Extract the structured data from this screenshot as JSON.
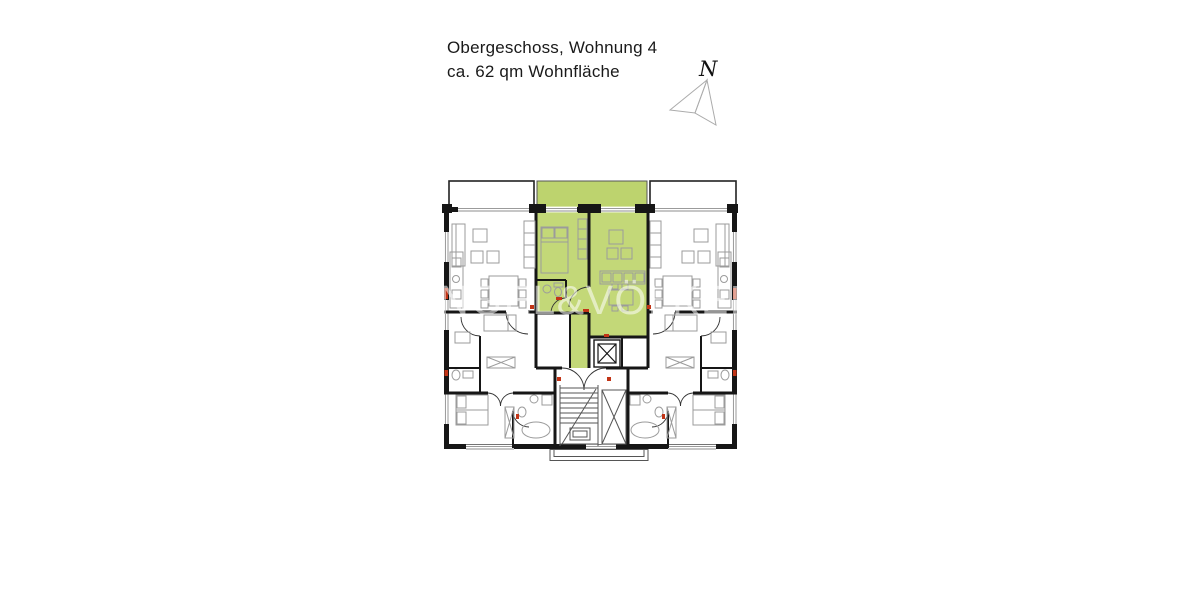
{
  "header": {
    "line1": "Obergeschoss, Wohnung 4",
    "line2": "ca. 62 qm Wohnfläche"
  },
  "compass": {
    "label": "N"
  },
  "watermark": {
    "text": "ENGEL&VÖLKERS"
  },
  "colors": {
    "text": "#1a1a1a",
    "wall": "#161616",
    "highlight": "#c3d878",
    "highlight_balcony": "#bdd36e",
    "furniture": "#9b9b9b",
    "window": "#8d8d8d",
    "accent_red": "#c23416",
    "compass_line": "#ababab",
    "watermark": "rgba(255,255,255,0.55)"
  }
}
